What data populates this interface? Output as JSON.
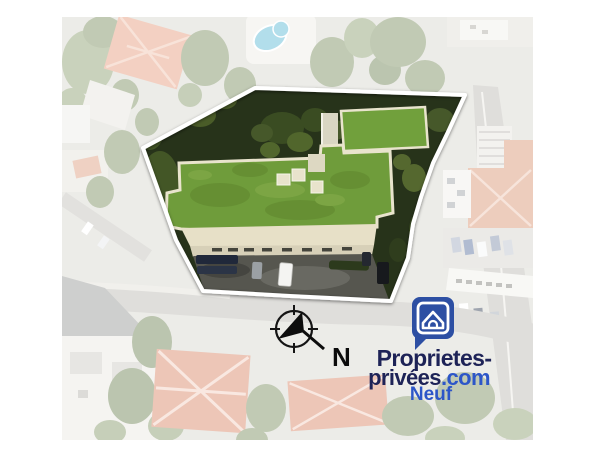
{
  "image": {
    "kind": "aerial-property-marketing-visual",
    "north_label": "N"
  },
  "logo": {
    "icon": "house-speech-bubble-icon",
    "line1": "Proprietes-",
    "line2_name": "privées",
    "line2_tld": ".com",
    "line3": "Neuf"
  },
  "colors": {
    "page_bg": "#ffffff",
    "brand_navy": "#1e2357",
    "brand_blue": "#2d56c8",
    "icon_blue": "#2d4fa3",
    "parcel_outline": "#ffffff",
    "roof_green": "#6f9c3b",
    "roof_green_block": "#71a03c",
    "building_beige": "#e7e0c7",
    "vegetation_dark": "#27331a",
    "compass_black": "#0b0b0b"
  }
}
